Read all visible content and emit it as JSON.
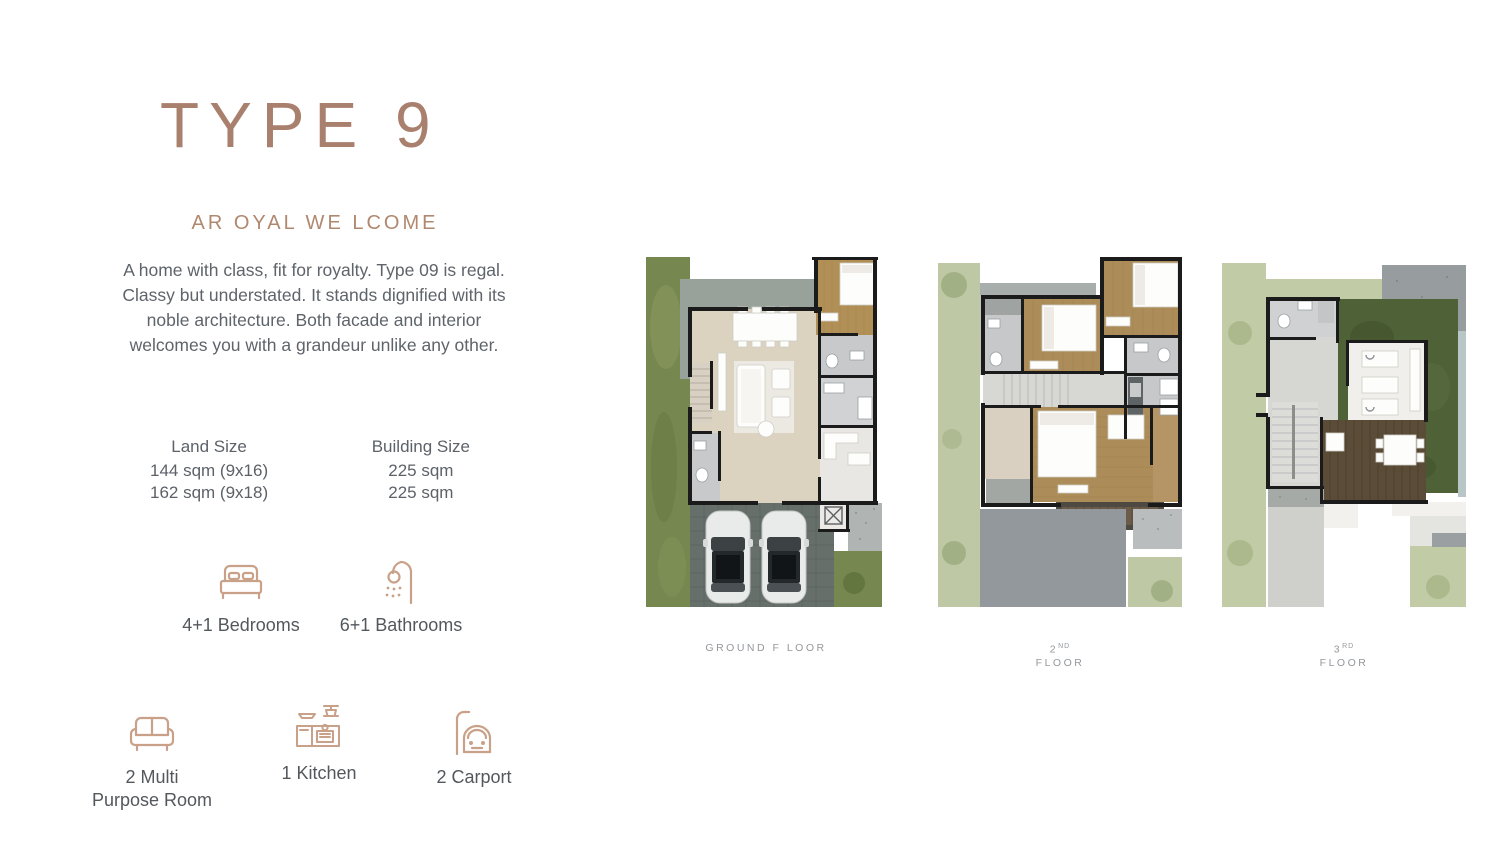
{
  "header": {
    "title": "TYPE 9",
    "subtitle": "AR OYAL WE LCOME",
    "description": "A home with class, fit for royalty. Type 09 is regal. Classy but understated. It stands dignified with its noble architecture. Both facade and interior welcomes you with a grandeur unlike any other."
  },
  "sizes": {
    "land": {
      "label": "Land Size",
      "rows": [
        "144 sqm (9x16)",
        "162 sqm (9x18)"
      ]
    },
    "building": {
      "label": "Building Size",
      "rows": [
        "225 sqm",
        "225 sqm"
      ]
    }
  },
  "features": {
    "bedrooms": {
      "icon": "bed-icon",
      "label": "4+1 Bedrooms"
    },
    "bathrooms": {
      "icon": "shower-icon",
      "label": "6+1 Bathrooms"
    },
    "multipurpose": {
      "icon": "sofa-icon",
      "label_line1": "2 Multi",
      "label_line2": "Purpose Room"
    },
    "kitchen": {
      "icon": "kitchen-icon",
      "label": "1 Kitchen"
    },
    "carport": {
      "icon": "car-icon",
      "label": "2 Carport"
    }
  },
  "floors": {
    "ground": {
      "label": "GROUND F LOOR"
    },
    "second": {
      "num": "2",
      "sup": "ND",
      "word": "FLOOR"
    },
    "third": {
      "num": "3",
      "sup": "RD",
      "word": "FLOOR"
    }
  },
  "colors": {
    "accent_brown": "#a97f6e",
    "icon_tan": "#c9a188",
    "body_text_gray": "#5e646a",
    "floor_label_gray": "#94989c",
    "grass_dark": "#76874f",
    "grass_light": "#bec8a4",
    "wood_floor": "#b19057",
    "tile_gray": "#c7c9ca",
    "wall_black": "#1b1b1b",
    "carport_paving": "#666f69",
    "roof_gray": "#92989b",
    "roof_garden_green": "#4f6137",
    "deck_brown": "#5b4c38"
  }
}
